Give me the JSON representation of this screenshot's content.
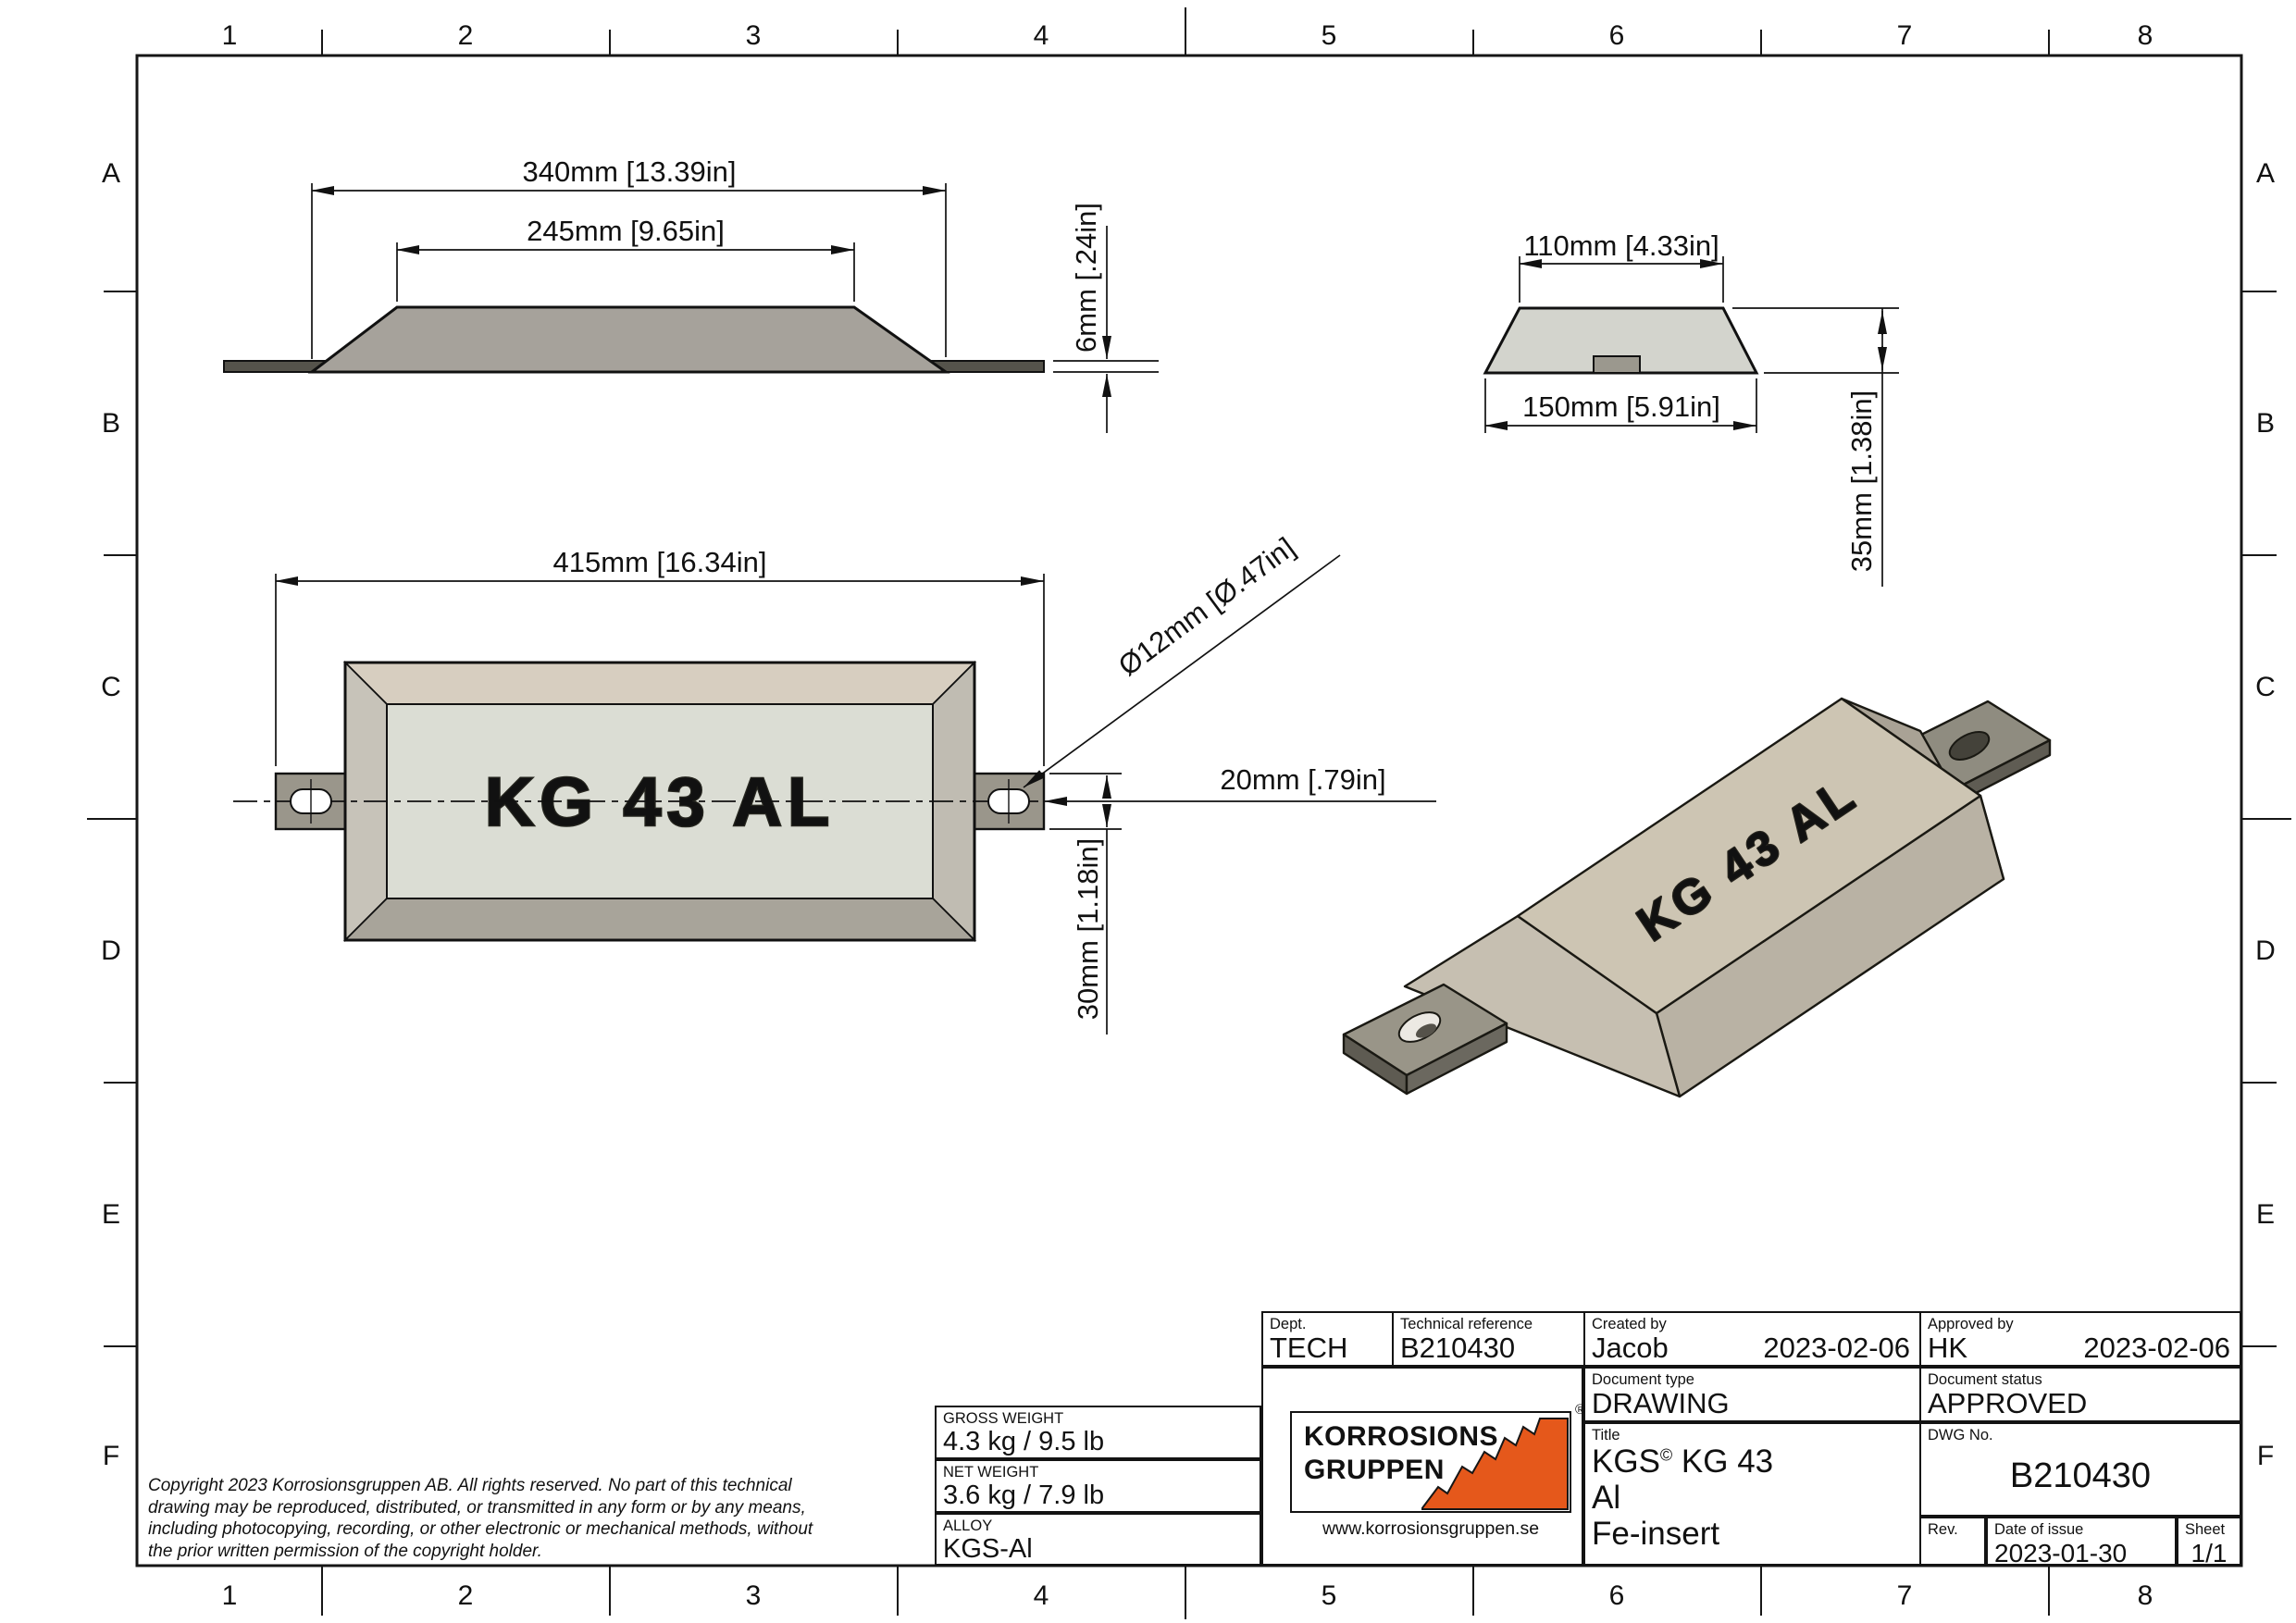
{
  "border": {
    "cols": [
      "1",
      "2",
      "3",
      "4",
      "5",
      "6",
      "7",
      "8"
    ],
    "rows": [
      "A",
      "B",
      "C",
      "D",
      "E",
      "F"
    ]
  },
  "views": {
    "side": {
      "dim_length": "340mm [13.39in]",
      "dim_top": "245mm [9.65in]",
      "dim_thickness": "6mm [.24in]"
    },
    "end": {
      "dim_top_width": "110mm [4.33in]",
      "dim_bottom_width": "150mm [5.91in]",
      "dim_height": "35mm [1.38in]"
    },
    "plan": {
      "part_label": "KG 43 AL",
      "dim_total_length": "415mm [16.34in]",
      "dim_hole": "Ø12mm [Ø.47in]",
      "dim_strap_width": "20mm [.79in]",
      "dim_offset": "30mm [1.18in]"
    },
    "iso": {
      "part_label": "KG 43 AL"
    }
  },
  "copyright": {
    "line1": "Copyright 2023 Korrosionsgruppen AB. All rights reserved. No part of this technical",
    "line2": "drawing may be reproduced, distributed, or transmitted in any form or by any means,",
    "line3": "including photocopying, recording, or other electronic or mechanical methods, without",
    "line4": "the prior written permission of the copyright holder."
  },
  "weights": {
    "gross_label": "GROSS WEIGHT",
    "gross_value": "4.3 kg / 9.5 lb",
    "net_label": "NET WEIGHT",
    "net_value": "3.6 kg / 7.9 lb",
    "alloy_label": "ALLOY",
    "alloy_value": "KGS-Al"
  },
  "logo": {
    "line1": "KORROSIONS",
    "line2": "GRUPPEN",
    "registered": "®",
    "url": "www.korrosionsgruppen.se"
  },
  "title_block": {
    "dept_label": "Dept.",
    "dept_value": "TECH",
    "tech_ref_label": "Technical reference",
    "tech_ref_value": "B210430",
    "created_label": "Created by",
    "created_by": "Jacob",
    "created_date": "2023-02-06",
    "approved_label": "Approved by",
    "approved_by": "HK",
    "approved_date": "2023-02-06",
    "doc_type_label": "Document type",
    "doc_type_value": "DRAWING",
    "doc_status_label": "Document status",
    "doc_status_value": "APPROVED",
    "title_label": "Title",
    "title_pre": "KGS",
    "title_sup": "©",
    "title_post": " KG 43",
    "title_line2": "Al",
    "title_line3": "Fe-insert",
    "dwg_label": "DWG No.",
    "dwg_value": "B210430",
    "rev_label": "Rev.",
    "date_issue_label": "Date of issue",
    "date_issue_value": "2023-01-30",
    "sheet_label": "Sheet",
    "sheet_value": "1/1"
  },
  "colors": {
    "accent_orange": "#e5581b",
    "anode_grey": "#a6a29b",
    "strap_grey": "#55534b",
    "face_light": "#dbddd4",
    "iso_beige": "#cdc5b3"
  }
}
